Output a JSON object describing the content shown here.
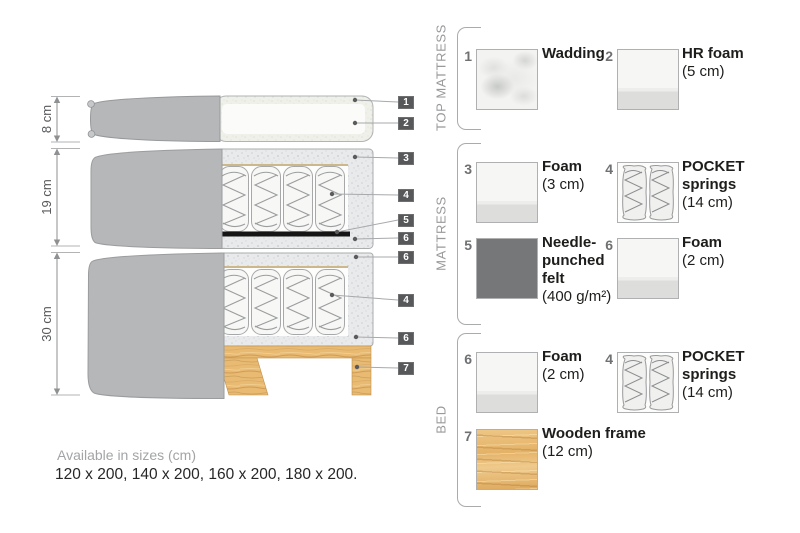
{
  "diagram": {
    "dim_labels": [
      "8 cm",
      "19 cm",
      "30 cm"
    ],
    "callouts": [
      "1",
      "2",
      "3",
      "4",
      "5",
      "6",
      "6",
      "4",
      "6",
      "7"
    ]
  },
  "legend": {
    "sections": [
      {
        "title": "TOP MATTRESS",
        "items": [
          {
            "number": "1",
            "name": "Wadding",
            "size": ""
          },
          {
            "number": "2",
            "name": "HR foam",
            "size": "(5 cm)"
          }
        ]
      },
      {
        "title": "MATTRESS",
        "items": [
          {
            "number": "3",
            "name": "Foam",
            "size": "(3 cm)"
          },
          {
            "number": "4",
            "name": "POCKET\nsprings",
            "size": "(14 cm)"
          },
          {
            "number": "5",
            "name": "Needle-\npunched\nfelt",
            "size": "(400 g/m²)"
          },
          {
            "number": "6",
            "name": "Foam",
            "size": "(2 cm)"
          }
        ]
      },
      {
        "title": "BED",
        "items": [
          {
            "number": "6",
            "name": "Foam",
            "size": "(2 cm)"
          },
          {
            "number": "4",
            "name": "POCKET\nsprings",
            "size": "(14 cm)"
          },
          {
            "number": "7",
            "name": "Wooden frame",
            "size": "(12 cm)"
          }
        ]
      }
    ]
  },
  "footer": {
    "title": "Available in sizes (cm)",
    "sizes": "120 x 200, 140 x 200, 160 x 200, 180 x 200."
  }
}
